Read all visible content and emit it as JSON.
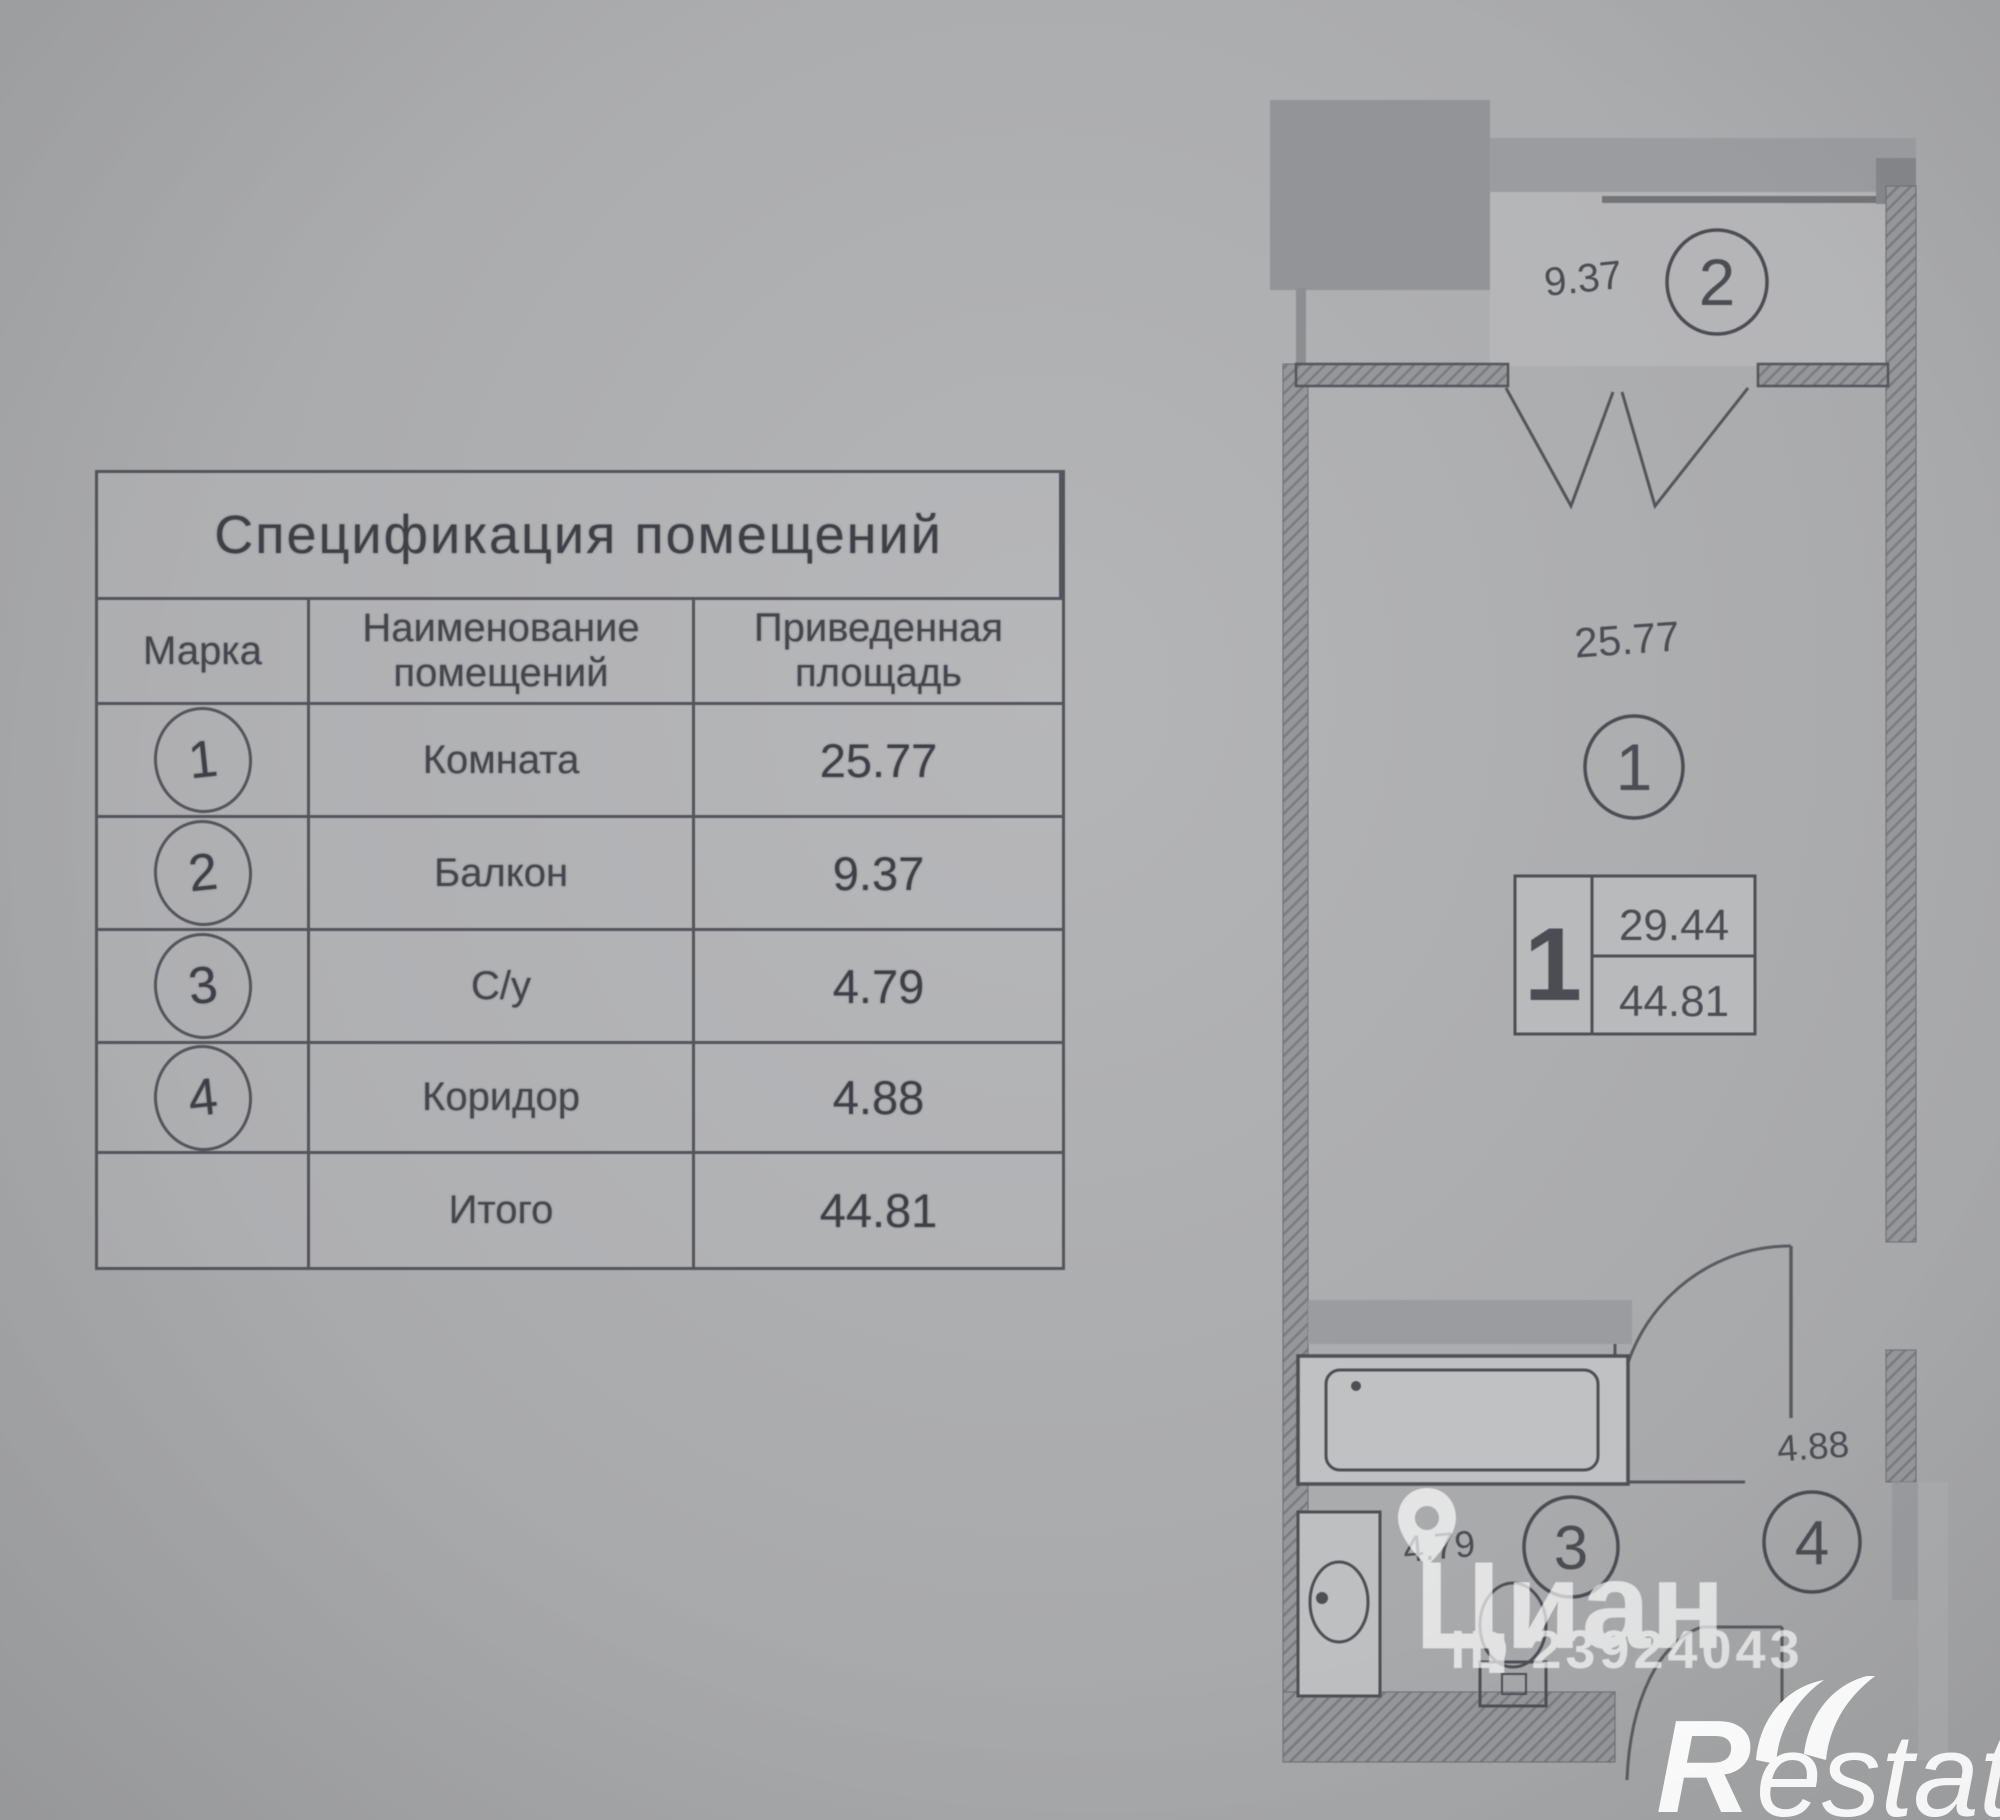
{
  "spec_table": {
    "title": "Спецификация помещений",
    "columns": [
      "Марка",
      "Наименование помещений",
      "Приведенная площадь"
    ],
    "rows": [
      {
        "mark": "1",
        "name": "Комната",
        "area": "25.77"
      },
      {
        "mark": "2",
        "name": "Балкон",
        "area": "9.37"
      },
      {
        "mark": "3",
        "name": "С/у",
        "area": "4.79"
      },
      {
        "mark": "4",
        "name": "Коридор",
        "area": "4.88"
      },
      {
        "mark": "",
        "name": "Итого",
        "area": "44.81"
      }
    ]
  },
  "floor_plan": {
    "balcony": {
      "mark": "2",
      "area": "9.37"
    },
    "room": {
      "mark": "1",
      "area": "25.77"
    },
    "bathroom": {
      "mark": "3",
      "area": "4.79"
    },
    "corridor": {
      "mark": "4",
      "area": "4.88"
    },
    "summary_box": {
      "rooms": "1",
      "upper_area": "29.44",
      "total_area": "44.81"
    }
  },
  "watermarks": {
    "site": "Циан",
    "listing_id": "ID 23924043",
    "agency_r": "R",
    "agency_rest": "estate"
  },
  "colors": {
    "background": "#a8a9ab",
    "line": "#54555b",
    "wall_fill": "#96979a",
    "text": "#46474d",
    "watermark": "#ffffff"
  }
}
